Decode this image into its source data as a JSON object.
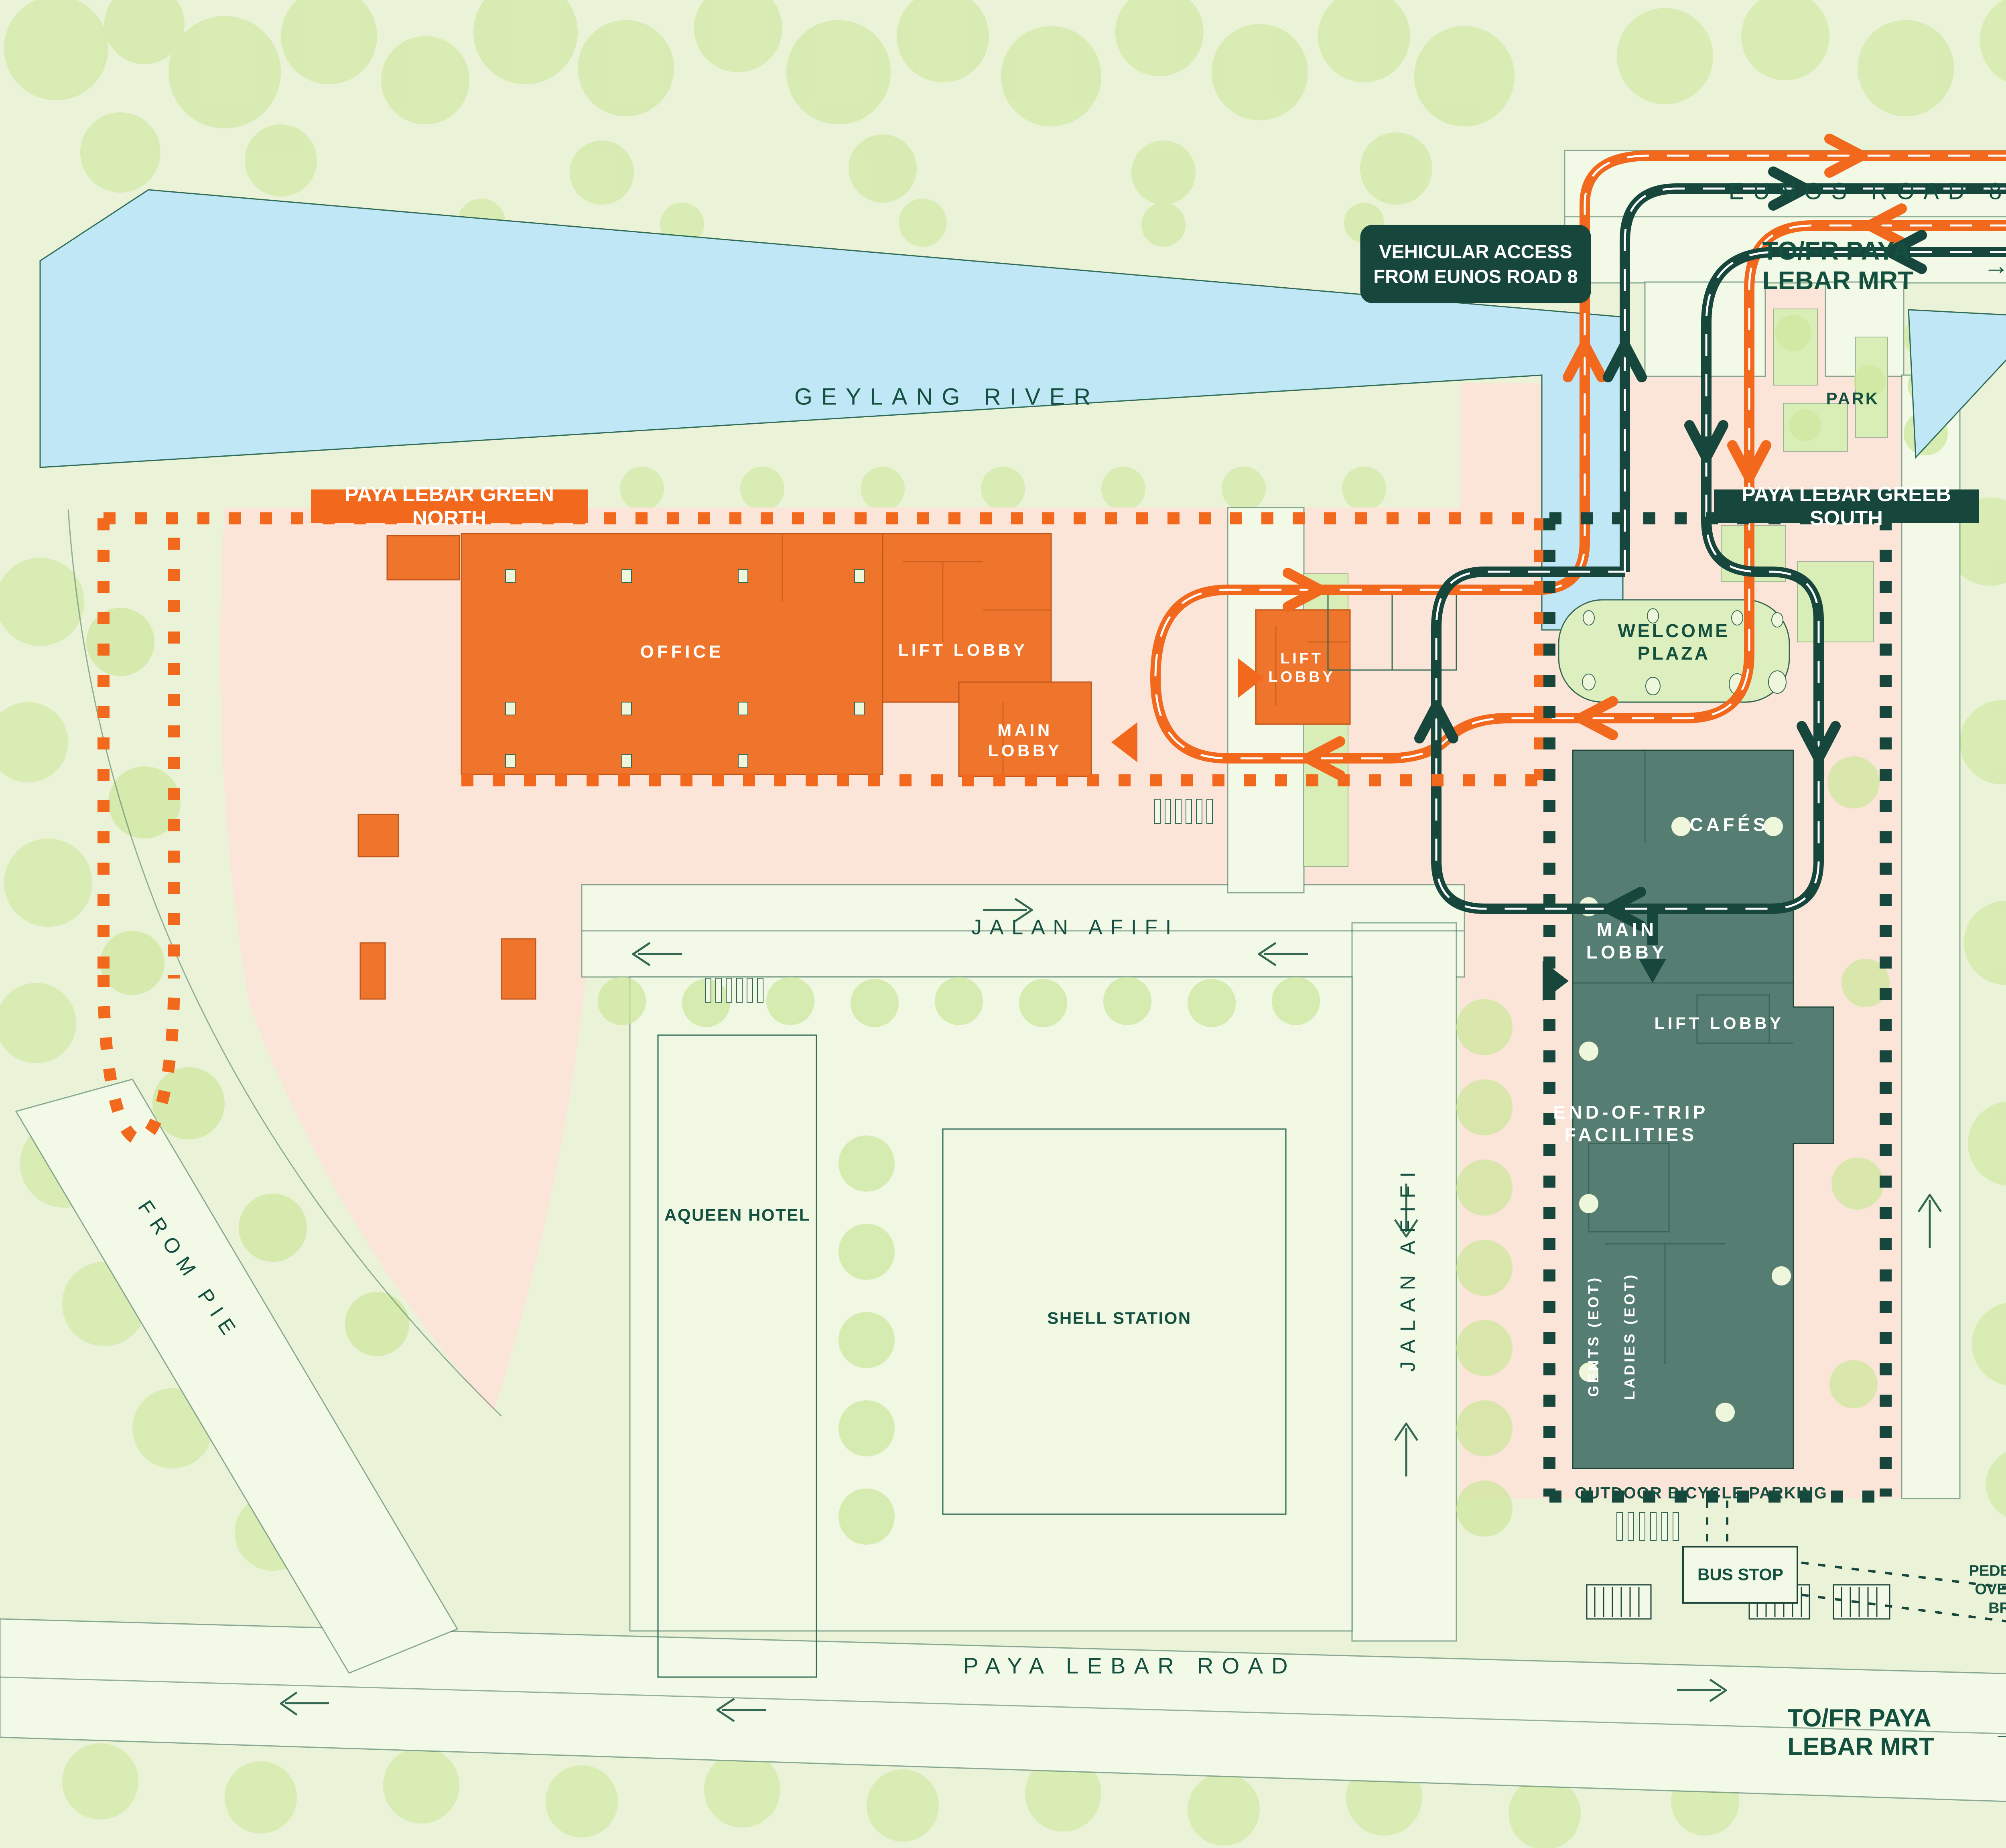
{
  "colors": {
    "background": "#EAF3D7",
    "foliage": "#CDE79E",
    "river_blue": "#BFE7F5",
    "site_pink": "#FBE5D8",
    "road_pale": "#F2F9E6",
    "accent_orange": "#F2691D",
    "dark_green": "#17463C",
    "building_orange": "#F0752C",
    "building_teal": "#567D71",
    "plaza_green": "#DDEFBE",
    "label_green": "#14503F"
  },
  "roads": {
    "eunos": "EUNOS ROAD 8",
    "jalan_afifi": "JALAN AFIFI",
    "paya_lebar": "PAYA LEBAR ROAD",
    "from_pie": "FROM PIE"
  },
  "water": {
    "geylang_river": "GEYLANG RIVER"
  },
  "badges": {
    "north": "PAYA LEBAR GREEN NORTH",
    "south": "PAYA LEBAR GREEB SOUTH",
    "vehicular_line1": "VEHICULAR ACCESS",
    "vehicular_line2": "FROM EUNOS ROAD 8"
  },
  "directions": {
    "mrt_top": "TO/FR PAYA LEBAR MRT",
    "mrt_bottom": "TO/FR PAYA LEBAR MRT",
    "arrow": "→"
  },
  "north_building": {
    "office": "OFFICE",
    "lift_lobby": "LIFT LOBBY",
    "main_lobby": "MAIN LOBBY",
    "central_lift_lobby": "LIFT LOBBY"
  },
  "south_building": {
    "cafes": "CAFÉS",
    "main_lobby": "MAIN LOBBY",
    "lift_lobby": "LIFT LOBBY",
    "eot": "END-OF-TRIP FACILITIES",
    "gents": "GENTS (EOT)",
    "ladies": "LADIES (EOT)"
  },
  "places": {
    "welcome_plaza": "WELCOME PLAZA",
    "park": "PARK",
    "aqueen": "AQUEEN HOTEL",
    "shell": "SHELL STATION",
    "bicycle": "OUTDOOR BICYCLE PARKING",
    "bus_stop": "BUS STOP",
    "bridge": "PEDESTRIAN OVERHEAD BRIDGE"
  }
}
